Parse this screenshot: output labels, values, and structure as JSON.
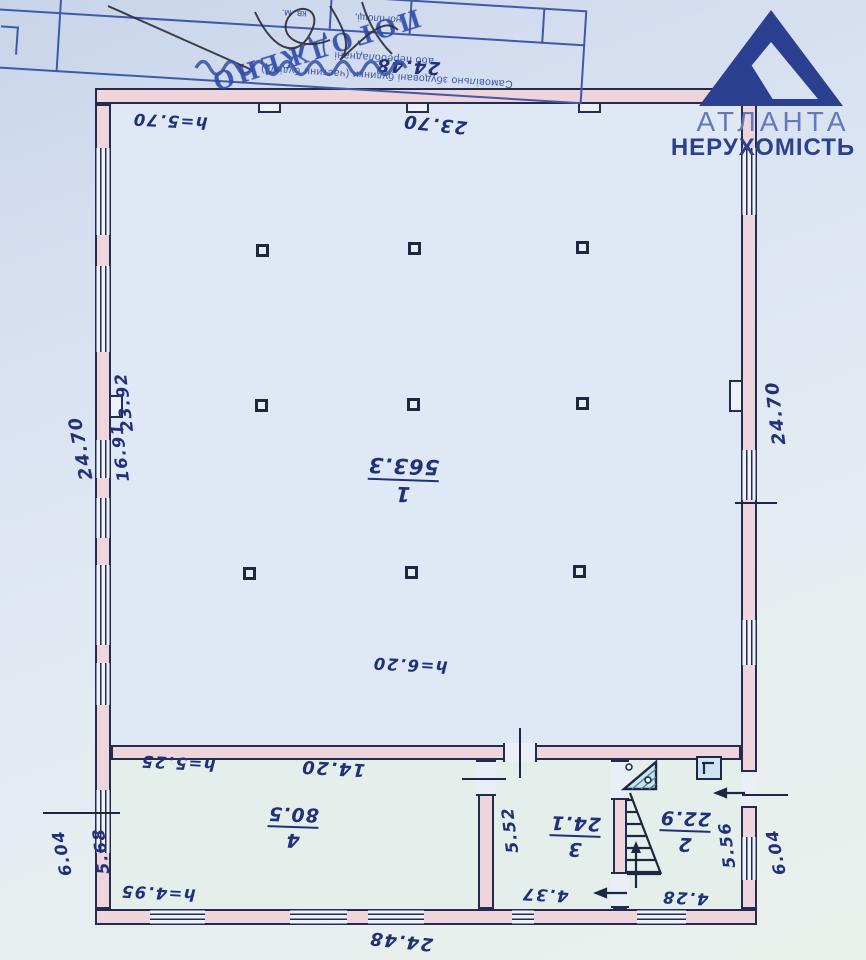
{
  "document_type": "floor-plan-scan",
  "colors": {
    "ink_handwriting": "#22307a",
    "plan_line": "#1d2742",
    "wall_fill": "#eed4db",
    "paper": "#dde6f2",
    "stamp_blue": "#3b55a8",
    "logo_dark": "#2c4092",
    "logo_light": "#6479bc",
    "symbol_fill": "#c9e6ef"
  },
  "watermark": {
    "logo": "triangle-logo",
    "line1": "АТЛАНТА",
    "line2": "НЕРУХОМІСТЬ"
  },
  "stamp": {
    "word": "ПОГОДЖЕНО",
    "line1": "Самовільно збудовані будинки (частини будівлі)",
    "line2": "або переобладнані",
    "cell_a": "кв. м.",
    "cell_b": "ної площі,"
  },
  "rooms": [
    {
      "number": "1",
      "area": "563.3"
    },
    {
      "number": "2",
      "area": "22.9"
    },
    {
      "number": "3",
      "area": "24.1"
    },
    {
      "number": "4",
      "area": "80.5"
    }
  ],
  "labels": {
    "dim_top": "24.48",
    "dim_top_inner": "23.70",
    "h_top_left": "h=5.70",
    "dim_left_outer": "24.70",
    "dim_left_inner_a": "23.92",
    "dim_left_inner_b": "16.91",
    "dim_right_outer": "24.70",
    "h_center": "h=6.20",
    "h_room4_top": "h=5.25",
    "dim_room4_width": "14.20",
    "h_room4_bottom": "h=4.95",
    "dim_room4_depth": "5.68",
    "dim_left_bottom_outer": "6.04",
    "dim_room3_depth": "5.52",
    "dim_room3_width": "4.37",
    "dim_room2_width": "4.28",
    "dim_room2_depth": "5.56",
    "dim_right_bottom_outer": "6.04",
    "dim_bottom": "24.48"
  }
}
